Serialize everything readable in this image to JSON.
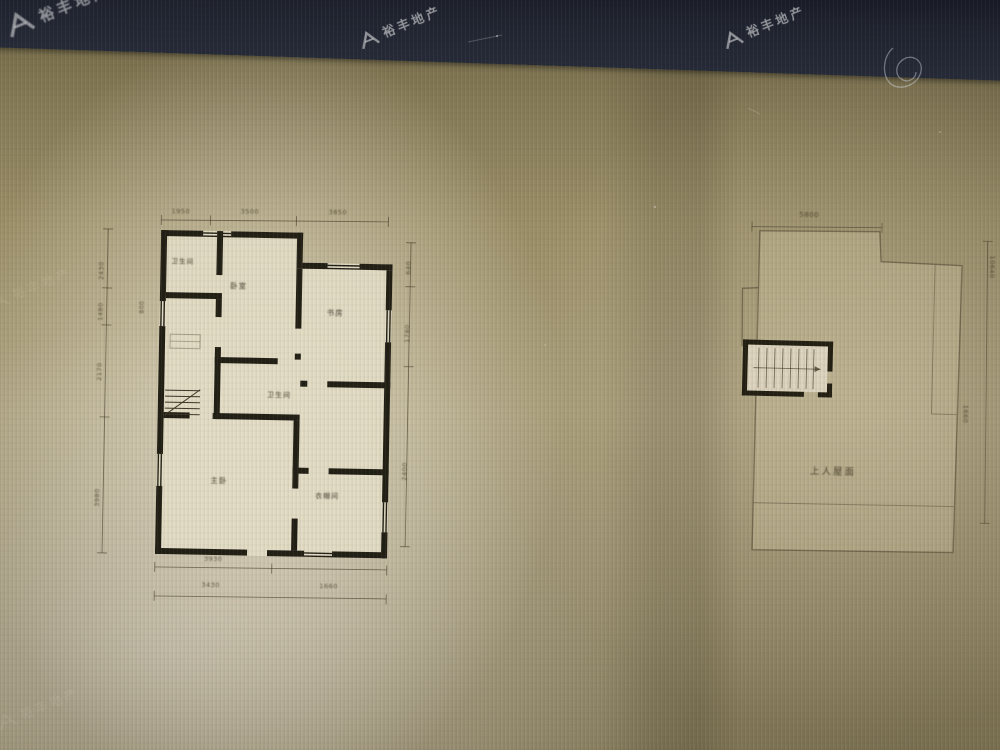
{
  "watermark": {
    "brand": "裕丰地产"
  },
  "left_plan": {
    "rooms": {
      "bath_top": "卫生间",
      "bedroom": "卧室",
      "study": "书房",
      "bath_mid": "卫生间",
      "master": "主卧",
      "closet": "衣帽间"
    },
    "dims": {
      "top": [
        "1950",
        "3500",
        "3850"
      ],
      "left": [
        "2430",
        "1480",
        "2170",
        "3980"
      ],
      "left_small": "800",
      "right": [
        "640",
        "1780",
        "2400"
      ],
      "bottom_row1": "3930",
      "bottom_row2": [
        "3430",
        "1660"
      ]
    }
  },
  "right_plan": {
    "area_label": "上人屋面",
    "dims": {
      "top": "5800",
      "right": [
        "10640",
        "1660"
      ]
    }
  }
}
